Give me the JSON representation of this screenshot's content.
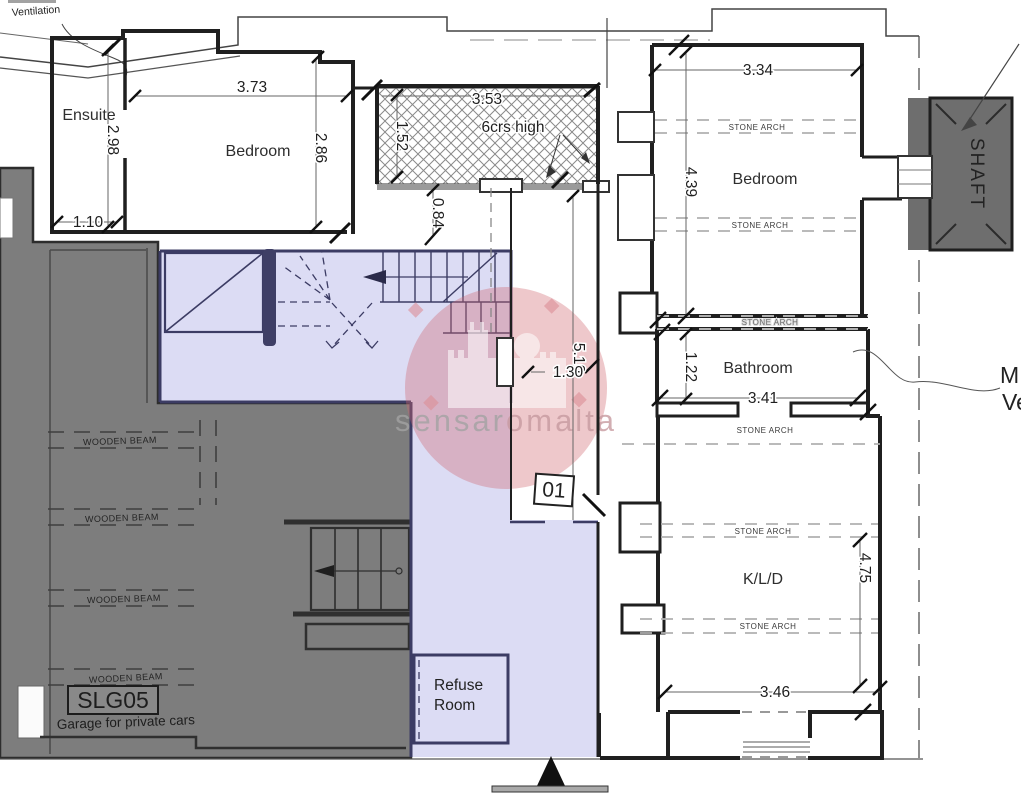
{
  "meta": {
    "watermark_part1": "sensar",
    "watermark_part2": "omalta"
  },
  "notes": {
    "ventilation": "Ventilation",
    "yard_height": "6crs high",
    "unit_number": "01",
    "side_note_line1": "M",
    "side_note_line2": "Ve"
  },
  "rooms": {
    "ensuite": "Ensuite",
    "bedroom_left": "Bedroom",
    "bedroom_right": "Bedroom",
    "bathroom": "Bathroom",
    "kld": "K/L/D",
    "refuse_line1": "Refuse",
    "refuse_line2": "Room",
    "shaft": "SHAFT"
  },
  "garage": {
    "code": "SLG05",
    "description": "Garage for private cars",
    "beam_label": "WOODEN BEAM"
  },
  "arch_label": {
    "stone_arch": "STONE ARCH"
  },
  "dimensions": {
    "ensuite_height": "2.98",
    "ensuite_door": "1.10",
    "bedroom_left_width": "3.73",
    "bedroom_left_height": "2.86",
    "yard_width": "3.53",
    "yard_side": "1.52",
    "yard_offset": "0.84",
    "bedroom_right_width": "3.34",
    "bedroom_right_height": "4.39",
    "bathroom_height": "1.22",
    "bathroom_width": "3.41",
    "corridor_length": "5.10",
    "landing_width": "1.30",
    "kld_height": "4.75",
    "kld_width": "3.46"
  },
  "colors": {
    "garage_fill": "#7d7d7d",
    "residential_fill": "#dcdcf4",
    "wall": "#1f1f1f",
    "shaft_fill": "#6e6e6e",
    "watermark_pink": "#d0666f"
  }
}
